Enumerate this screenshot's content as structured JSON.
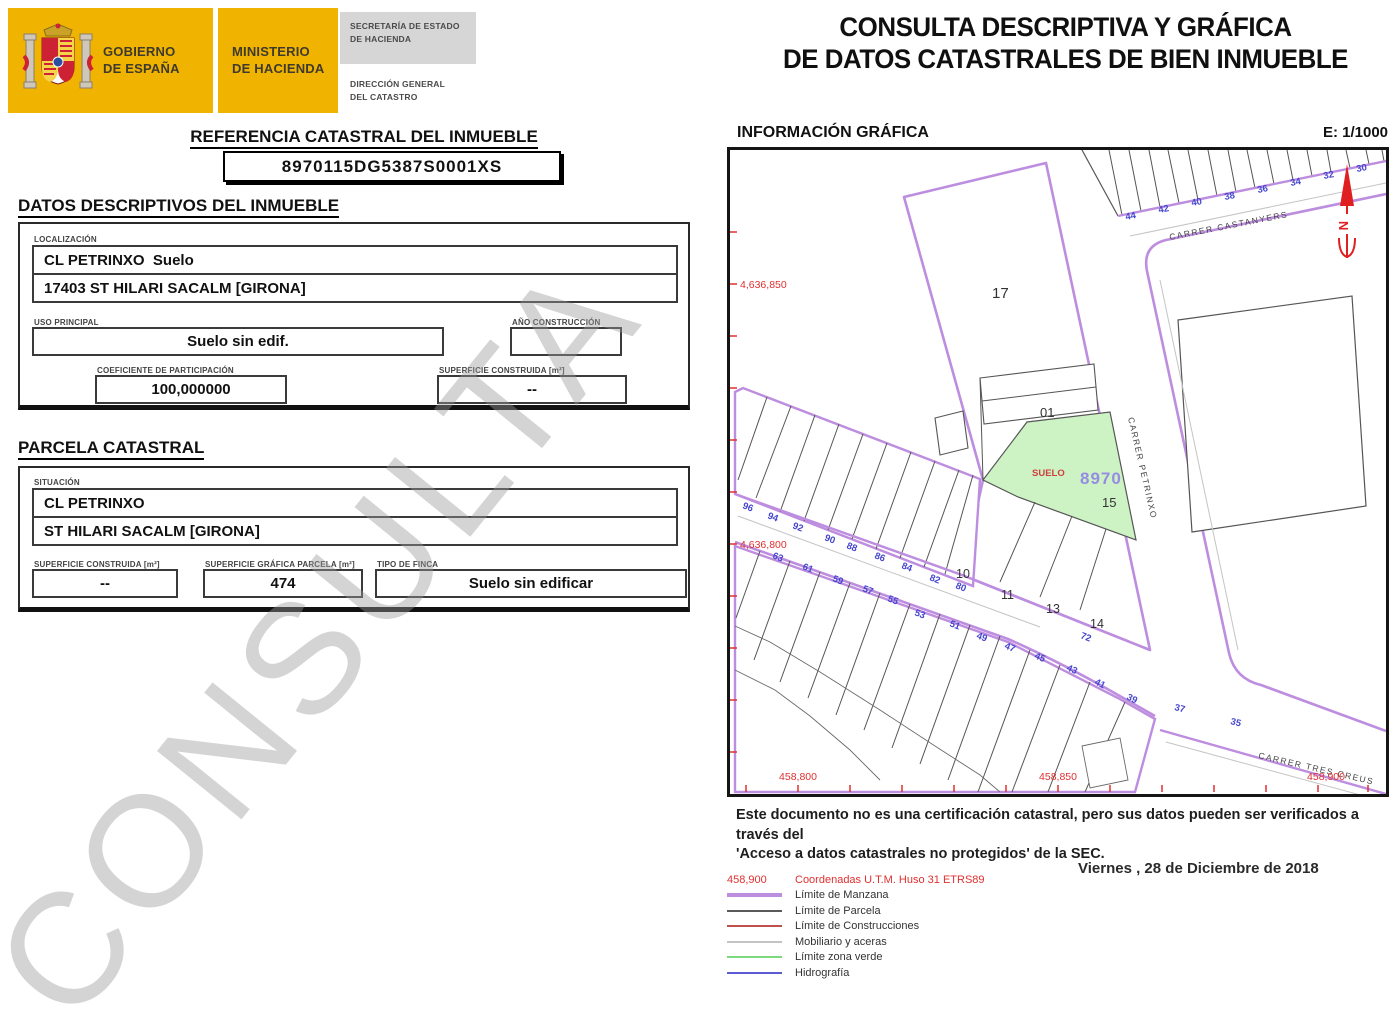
{
  "header": {
    "gobierno": "GOBIERNO\nDE ESPAÑA",
    "ministerio": "MINISTERIO\nDE HACIENDA",
    "secretaria": "SECRETARÍA DE ESTADO\nDE HACIENDA",
    "direccion": "DIRECCIÓN GENERAL\nDEL CATASTRO",
    "title_line1": "CONSULTA DESCRIPTIVA Y GRÁFICA",
    "title_line2": "DE DATOS CATASTRALES DE BIEN INMUEBLE"
  },
  "referencia": {
    "heading": "REFERENCIA CATASTRAL DEL INMUEBLE",
    "value": "8970115DG5387S0001XS"
  },
  "datos": {
    "heading": "DATOS DESCRIPTIVOS DEL INMUEBLE",
    "localizacion_label": "LOCALIZACIÓN",
    "localizacion_line1": "CL PETRINXO  Suelo",
    "localizacion_line2": "17403 ST HILARI SACALM [GIRONA]",
    "uso_label": "USO PRINCIPAL",
    "uso_value": "Suelo sin edif.",
    "anio_label": "AÑO CONSTRUCCIÓN",
    "anio_value": "",
    "coef_label": "COEFICIENTE DE PARTICIPACIÓN",
    "coef_value": "100,000000",
    "sup_label": "SUPERFICIE CONSTRUIDA [m²]",
    "sup_value": "--"
  },
  "parcela": {
    "heading": "PARCELA CATASTRAL",
    "situacion_label": "SITUACIÓN",
    "situacion_line1": "CL PETRINXO",
    "situacion_line2": "ST HILARI SACALM [GIRONA]",
    "sup_construida_label": "SUPERFICIE CONSTRUIDA [m²]",
    "sup_construida_value": "--",
    "sup_grafica_label": "SUPERFICIE GRÁFICA PARCELA [m²]",
    "sup_grafica_value": "474",
    "tipo_label": "TIPO DE FINCA",
    "tipo_value": "Suelo sin edificar"
  },
  "grafica": {
    "heading": "INFORMACIÓN GRÁFICA",
    "escala": "E: 1/1000",
    "map": {
      "street_names": [
        "CARRER CASTANYERS",
        "CARRER PETRINXO",
        "CARRER TRES CREUS"
      ],
      "parcel_labels": [
        "17",
        "01",
        "15",
        "10",
        "11",
        "13",
        "14"
      ],
      "suelo_label": "SUELO",
      "parcel_ref": "8970",
      "north_label": "N",
      "house_numbers_top": [
        "44",
        "42",
        "40",
        "38",
        "36",
        "34",
        "32",
        "30"
      ],
      "house_numbers_mid": [
        "96",
        "94",
        "92",
        "90",
        "88",
        "86",
        "84",
        "82",
        "80"
      ],
      "house_numbers_low": [
        "63",
        "61",
        "59",
        "57",
        "55",
        "53",
        "51",
        "49",
        "47",
        "45",
        "43",
        "41",
        "39",
        "37",
        "35"
      ],
      "house_number_72": "72",
      "coord_labels_left": [
        "4,636,850",
        "4,636,800"
      ],
      "coord_labels_bottom": [
        "458,800",
        "458,850",
        "458,900"
      ]
    }
  },
  "footer": {
    "disclaimer_line1": "Este documento no es una certificación catastral, pero sus datos pueden ser verificados a través del",
    "disclaimer_line2": "'Acceso a datos catastrales no protegidos' de la SEC.",
    "date": "Viernes , 28 de Diciembre de 2018",
    "legend": {
      "coords_sample": "458,900",
      "coords_label": "Coordenadas U.T.M. Huso 31 ETRS89",
      "items": [
        {
          "label": "Límite de Manzana",
          "color": "#bd8ddf",
          "width": 4
        },
        {
          "label": "Límite de Parcela",
          "color": "#5a5a5a",
          "width": 2
        },
        {
          "label": "Límite de Construcciones",
          "color": "#c0504d",
          "width": 2
        },
        {
          "label": "Mobiliario y aceras",
          "color": "#c4c4c4",
          "width": 2
        },
        {
          "label": "Límite zona verde",
          "color": "#7ed87e",
          "width": 2
        },
        {
          "label": "Hidrografía",
          "color": "#5b5bd6",
          "width": 2
        }
      ]
    }
  },
  "watermark": "CONSULTA",
  "colors": {
    "gov_yellow": "#f0b400",
    "manzana_purple": "#bd8ddf",
    "green_fill": "#cdf2c4",
    "number_blue": "#4646cf",
    "coord_red": "#e03030",
    "ref_purple": "#968ce4"
  }
}
